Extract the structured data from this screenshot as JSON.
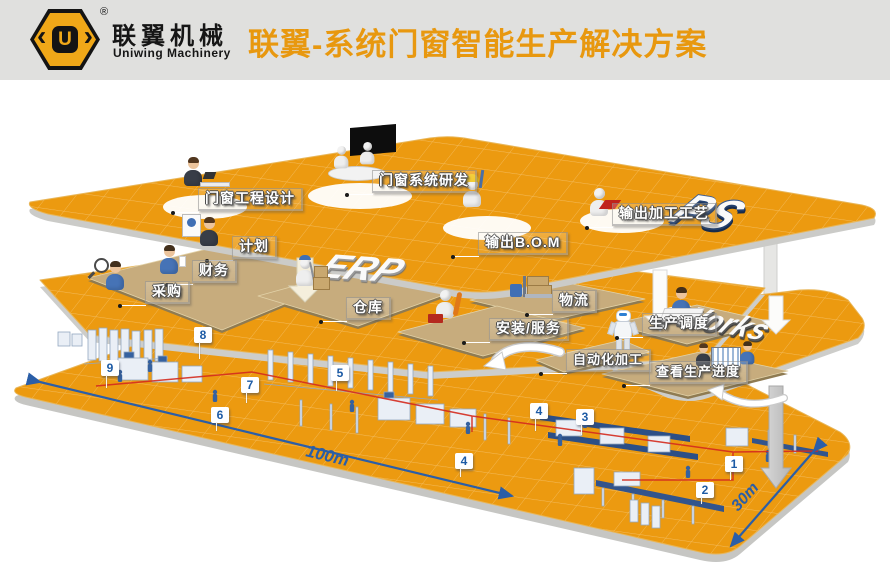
{
  "header": {
    "logo_cn": "联翼机械",
    "logo_en": "Uniwing Machinery",
    "registered_mark": "®",
    "logo_letter": "U",
    "title": "联翼-系统门窗智能生产解决方案"
  },
  "colors": {
    "accent_orange": "#E8980F",
    "platform_orange": "#EC9A10",
    "badge_blue": "#1D5BA5",
    "flow_red": "#D42B1F",
    "dimension_blue": "#2B5EA7"
  },
  "layer_titles": {
    "top": "PS",
    "middle": "ERP",
    "bottom": "eWorks"
  },
  "stations": {
    "engineering": "门窗工程设计",
    "rnd": "门窗系统研发",
    "bom": "输出B.O.M",
    "craft": "输出加工工艺",
    "plan": "计划",
    "finance": "财务",
    "purchase": "采购",
    "warehouse": "仓库",
    "logistics": "物流",
    "install": "安装/服务",
    "scheduling": "生产调度",
    "auto_processing": "自动化加工",
    "view_progress": "查看生产进度"
  },
  "floor_badges": [
    "9",
    "8",
    "7",
    "6",
    "5",
    "4",
    "4",
    "3",
    "2",
    "1"
  ],
  "dimensions": {
    "length": "100m",
    "width": "30m"
  }
}
